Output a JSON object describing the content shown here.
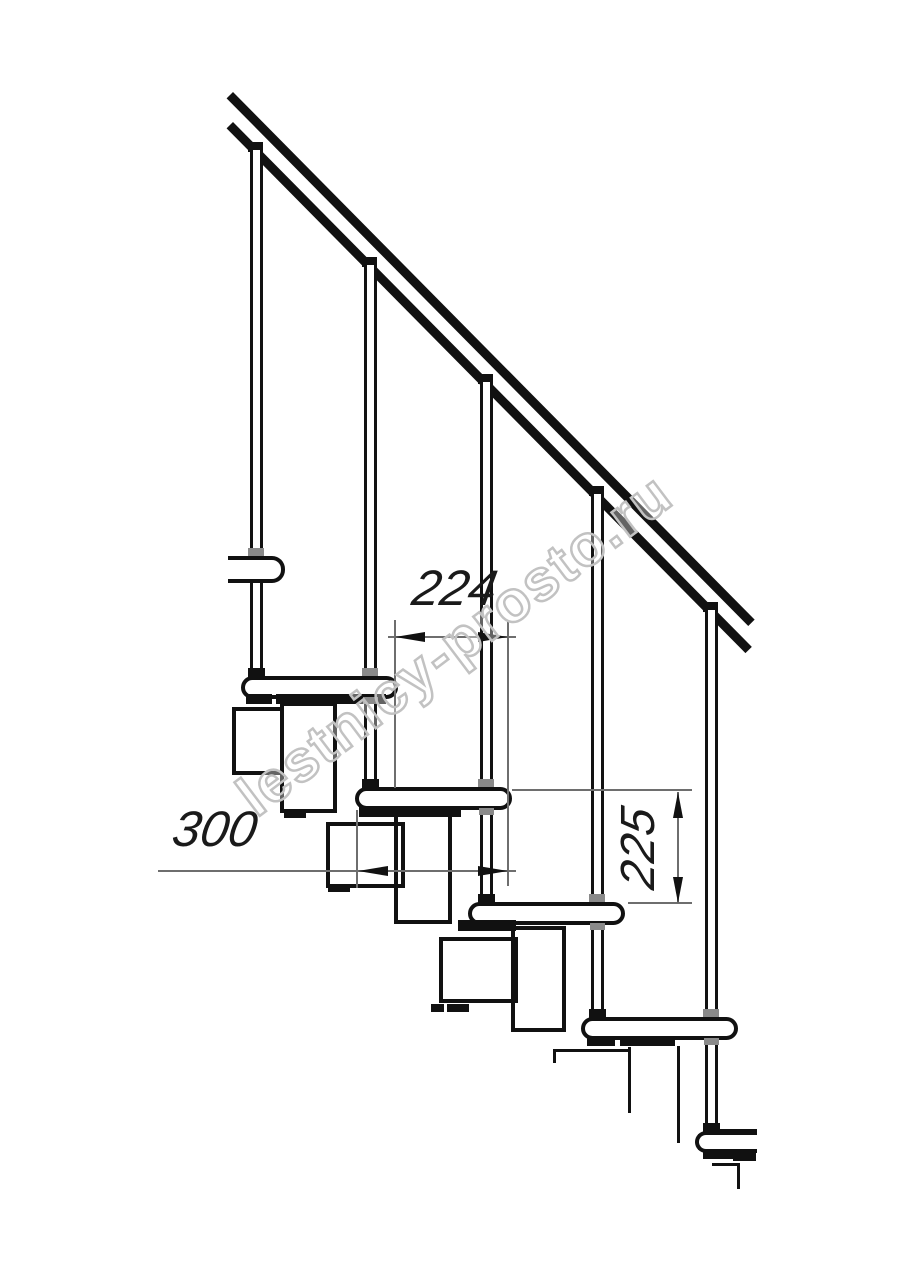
{
  "drawing": {
    "kind": "modular staircase side elevation",
    "dimensions": {
      "horizontal_upper": "224",
      "horizontal_lower": "300",
      "vertical": "225"
    },
    "watermark": {
      "text": "lestnicy-prosto.ru"
    },
    "colors": {
      "background": "#ffffff",
      "line": "#111111",
      "dimension_line": "#6e6e6e",
      "watermark_stroke": "#c2c2c2"
    }
  }
}
